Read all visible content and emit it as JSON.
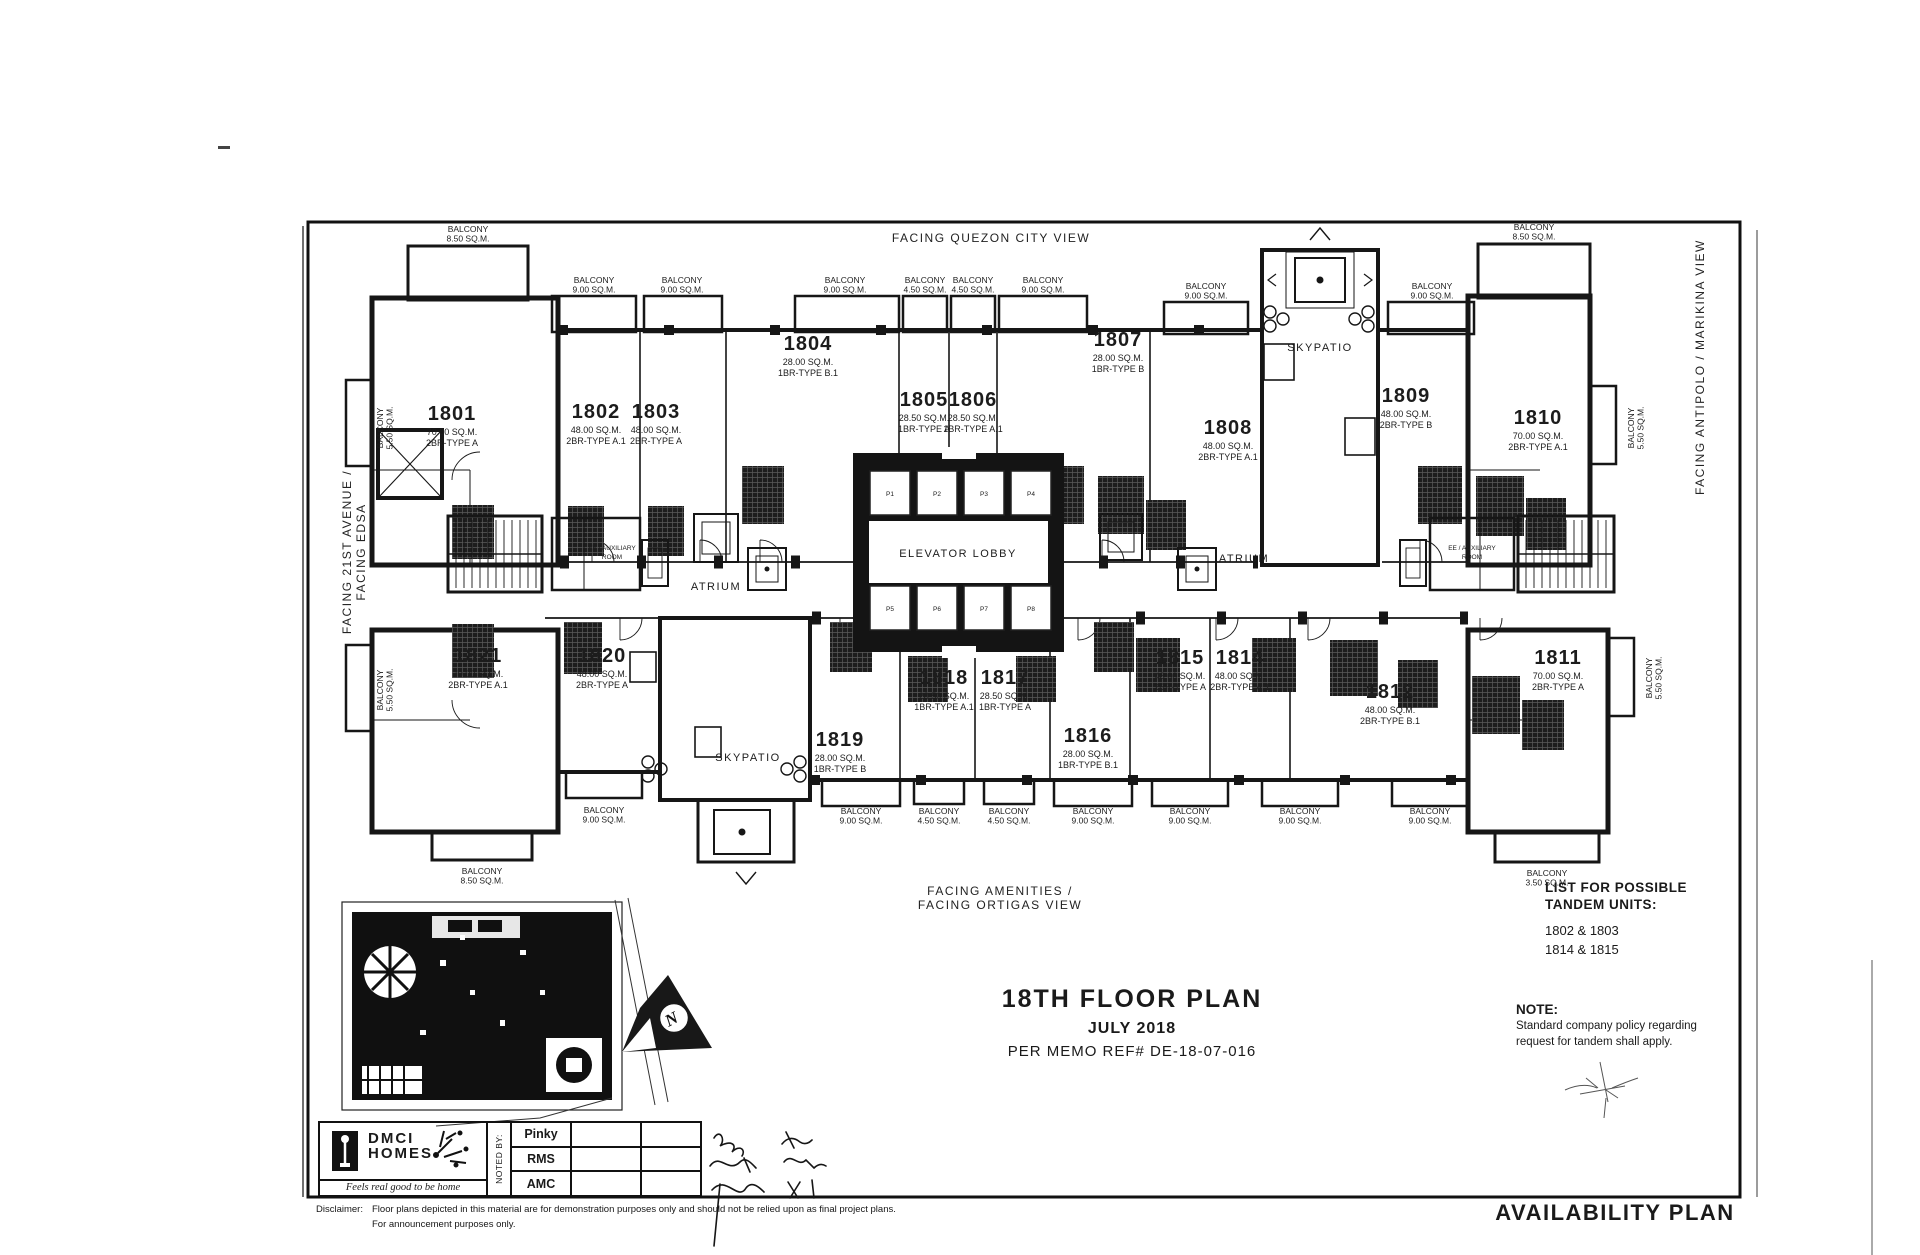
{
  "document": {
    "sheet_label": "AVAILABILITY PLAN",
    "title_line1": "18TH FLOOR PLAN",
    "title_line2": "JULY 2018",
    "title_line3": "PER MEMO REF# DE-18-07-016"
  },
  "views": {
    "top": "FACING QUEZON CITY VIEW",
    "left_line1": "FACING 21ST AVENUE /",
    "left_line2": "FACING EDSA",
    "right": "FACING ANTIPOLO / MARIKINA VIEW",
    "bottom_line1": "FACING AMENITIES /",
    "bottom_line2": "FACING ORTIGAS VIEW"
  },
  "labels": {
    "balcony": "BALCONY",
    "elevator_lobby": "ELEVATOR LOBBY",
    "atrium": "ATRIUM",
    "skypatio": "SKYPATIO",
    "aux_line1": "EE / AUXILIARY",
    "aux_line2": "ROOM"
  },
  "units": [
    {
      "id": "1801",
      "area": "70.00 SQ.M.",
      "type": "2BR-TYPE A"
    },
    {
      "id": "1802",
      "area": "48.00 SQ.M.",
      "type": "2BR-TYPE A.1"
    },
    {
      "id": "1803",
      "area": "48.00 SQ.M.",
      "type": "2BR-TYPE A"
    },
    {
      "id": "1804",
      "area": "28.00 SQ.M.",
      "type": "1BR-TYPE B.1"
    },
    {
      "id": "1805",
      "area": "28.50 SQ.M.",
      "type": "1BR-TYPE A"
    },
    {
      "id": "1806",
      "area": "28.50 SQ.M.",
      "type": "1BR-TYPE A.1"
    },
    {
      "id": "1807",
      "area": "28.00 SQ.M.",
      "type": "1BR-TYPE B"
    },
    {
      "id": "1808",
      "area": "48.00 SQ.M.",
      "type": "2BR-TYPE A.1"
    },
    {
      "id": "1809",
      "area": "48.00 SQ.M.",
      "type": "2BR-TYPE B"
    },
    {
      "id": "1810",
      "area": "70.00 SQ.M.",
      "type": "2BR-TYPE A.1"
    },
    {
      "id": "1811",
      "area": "70.00 SQ.M.",
      "type": "2BR-TYPE A"
    },
    {
      "id": "1812",
      "area": "48.00 SQ.M.",
      "type": "2BR-TYPE B.1"
    },
    {
      "id": "1814",
      "area": "48.00 SQ.M.",
      "type": "2BR-TYPE A.1"
    },
    {
      "id": "1815",
      "area": "48.00 SQ.M.",
      "type": "2BR-TYPE A"
    },
    {
      "id": "1816",
      "area": "28.00 SQ.M.",
      "type": "1BR-TYPE B.1"
    },
    {
      "id": "1817",
      "area": "28.50 SQ.M.",
      "type": "1BR-TYPE A"
    },
    {
      "id": "1818",
      "area": "28.50 SQ.M.",
      "type": "1BR-TYPE A.1"
    },
    {
      "id": "1819",
      "area": "28.00 SQ.M.",
      "type": "1BR-TYPE B"
    },
    {
      "id": "1820",
      "area": "48.00 SQ.M.",
      "type": "2BR-TYPE A"
    },
    {
      "id": "1821",
      "area": "70.00 SQ.M.",
      "type": "2BR-TYPE A.1"
    }
  ],
  "balconies": [
    {
      "size": "8.50 SQ.M."
    },
    {
      "size": "9.00 SQ.M."
    },
    {
      "size": "9.00 SQ.M."
    },
    {
      "size": "9.00 SQ.M."
    },
    {
      "size": "4.50 SQ.M."
    },
    {
      "size": "4.50 SQ.M."
    },
    {
      "size": "9.00 SQ.M."
    },
    {
      "size": "9.00 SQ.M."
    },
    {
      "size": "9.00 SQ.M."
    },
    {
      "size": "8.50 SQ.M."
    },
    {
      "size": "5.50 SQ.M."
    },
    {
      "size": "5.50 SQ.M."
    },
    {
      "size": "5.50 SQ.M."
    },
    {
      "size": "5.50 SQ.M."
    },
    {
      "size": "8.50 SQ.M."
    },
    {
      "size": "9.00 SQ.M."
    },
    {
      "size": "9.00 SQ.M."
    },
    {
      "size": "4.50 SQ.M."
    },
    {
      "size": "4.50 SQ.M."
    },
    {
      "size": "9.00 SQ.M."
    },
    {
      "size": "9.00 SQ.M."
    },
    {
      "size": "9.00 SQ.M."
    },
    {
      "size": "9.00 SQ.M."
    },
    {
      "size": "3.50 SQ.M."
    }
  ],
  "elevators": [
    "P1",
    "P2",
    "P3",
    "P4",
    "P5",
    "P6",
    "P7",
    "P8"
  ],
  "tandem": {
    "heading_line1": "LIST FOR POSSIBLE",
    "heading_line2": "TANDEM UNITS:",
    "pairs": [
      "1802 & 1803",
      "1814 & 1815"
    ]
  },
  "note": {
    "heading": "NOTE:",
    "line1": "Standard company policy regarding",
    "line2": "request for tandem shall apply."
  },
  "branding": {
    "name_line1": "DMCI",
    "name_line2": "HOMES",
    "tagline": "Feels real good to be home"
  },
  "approval": {
    "noted_by": "NOTED BY:",
    "rows": [
      "Pinky",
      "RMS",
      "AMC"
    ]
  },
  "compass": {
    "north": "N"
  },
  "disclaimer": {
    "label": "Disclaimer:",
    "line1": "Floor plans depicted in this material are for demonstration purposes only and should not be relied upon as final project plans.",
    "line2": "For announcement purposes only."
  }
}
